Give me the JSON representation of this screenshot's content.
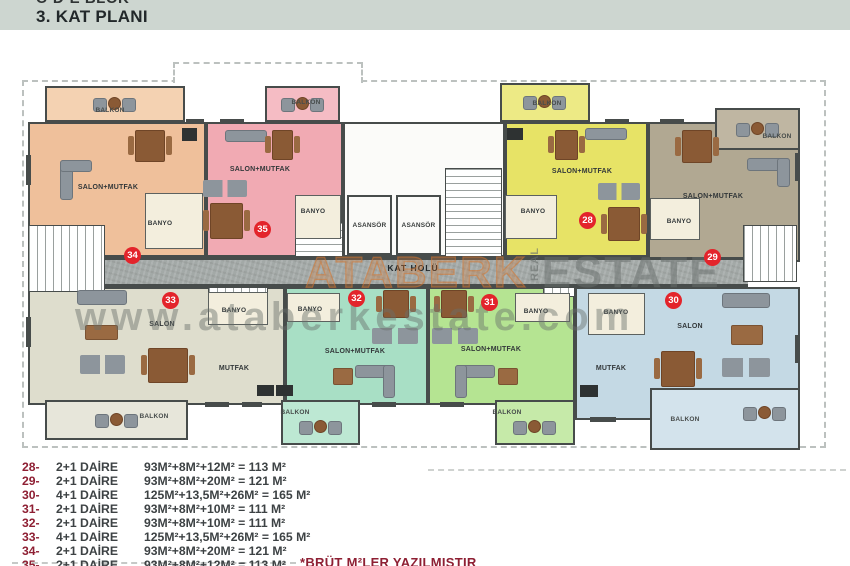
{
  "header": {
    "block_line": "C-D-E BLOK",
    "title": "3. KAT PLANI"
  },
  "labels": {
    "salon_mutfak": "SALON+MUTFAK",
    "salon": "SALON",
    "mutfak": "MUTFAK",
    "banyo": "BANYO",
    "balkon": "BALKON",
    "asansor": "ASANSÖR",
    "kat_holu": "KAT HOLÜ"
  },
  "apartments": [
    {
      "number": "28",
      "color": "#e7e366"
    },
    {
      "number": "29",
      "color": "#b1a892"
    },
    {
      "number": "30",
      "color": "#c4d9e4"
    },
    {
      "number": "31",
      "color": "#b5e492"
    },
    {
      "number": "32",
      "color": "#a8dfc5"
    },
    {
      "number": "33",
      "color": "#deddcd"
    },
    {
      "number": "34",
      "color": "#efc09b"
    },
    {
      "number": "35",
      "color": "#f1aab3"
    }
  ],
  "watermark": {
    "brand": "ATABERK",
    "brand_mid": "REAL",
    "brand_suffix": "ESTATE",
    "url": "www.ataberkestate.com"
  },
  "legend": {
    "rows": [
      {
        "num": "28-",
        "type": "2+1 DAİRE",
        "formula": "93M²+8M²+12M² = 113 M²"
      },
      {
        "num": "29-",
        "type": "2+1 DAİRE",
        "formula": "93M²+8M²+20M² = 121 M²"
      },
      {
        "num": "30-",
        "type": "4+1 DAİRE",
        "formula": "125M²+13,5M²+26M² = 165 M²"
      },
      {
        "num": "31-",
        "type": "2+1 DAİRE",
        "formula": "93M²+8M²+10M² = 111 M²"
      },
      {
        "num": "32-",
        "type": "2+1 DAİRE",
        "formula": "93M²+8M²+10M² = 111 M²"
      },
      {
        "num": "33-",
        "type": "4+1 DAİRE",
        "formula": "125M²+13,5M²+26M² = 165 M²"
      },
      {
        "num": "34-",
        "type": "2+1 DAİRE",
        "formula": "93M²+8M²+20M² = 121 M²"
      },
      {
        "num": "35-",
        "type": "2+1 DAİRE",
        "formula": "93M²+8M²+12M² = 113 M²"
      }
    ],
    "footnote": "*BRÜT M²LER YAZILMIŞTIR"
  },
  "colors": {
    "badge": "#e3242b",
    "legend_number": "#8e1f33",
    "header_bg": "#cdd6d0",
    "corridor": "#a3a9a7",
    "wall": "#474c4b"
  }
}
